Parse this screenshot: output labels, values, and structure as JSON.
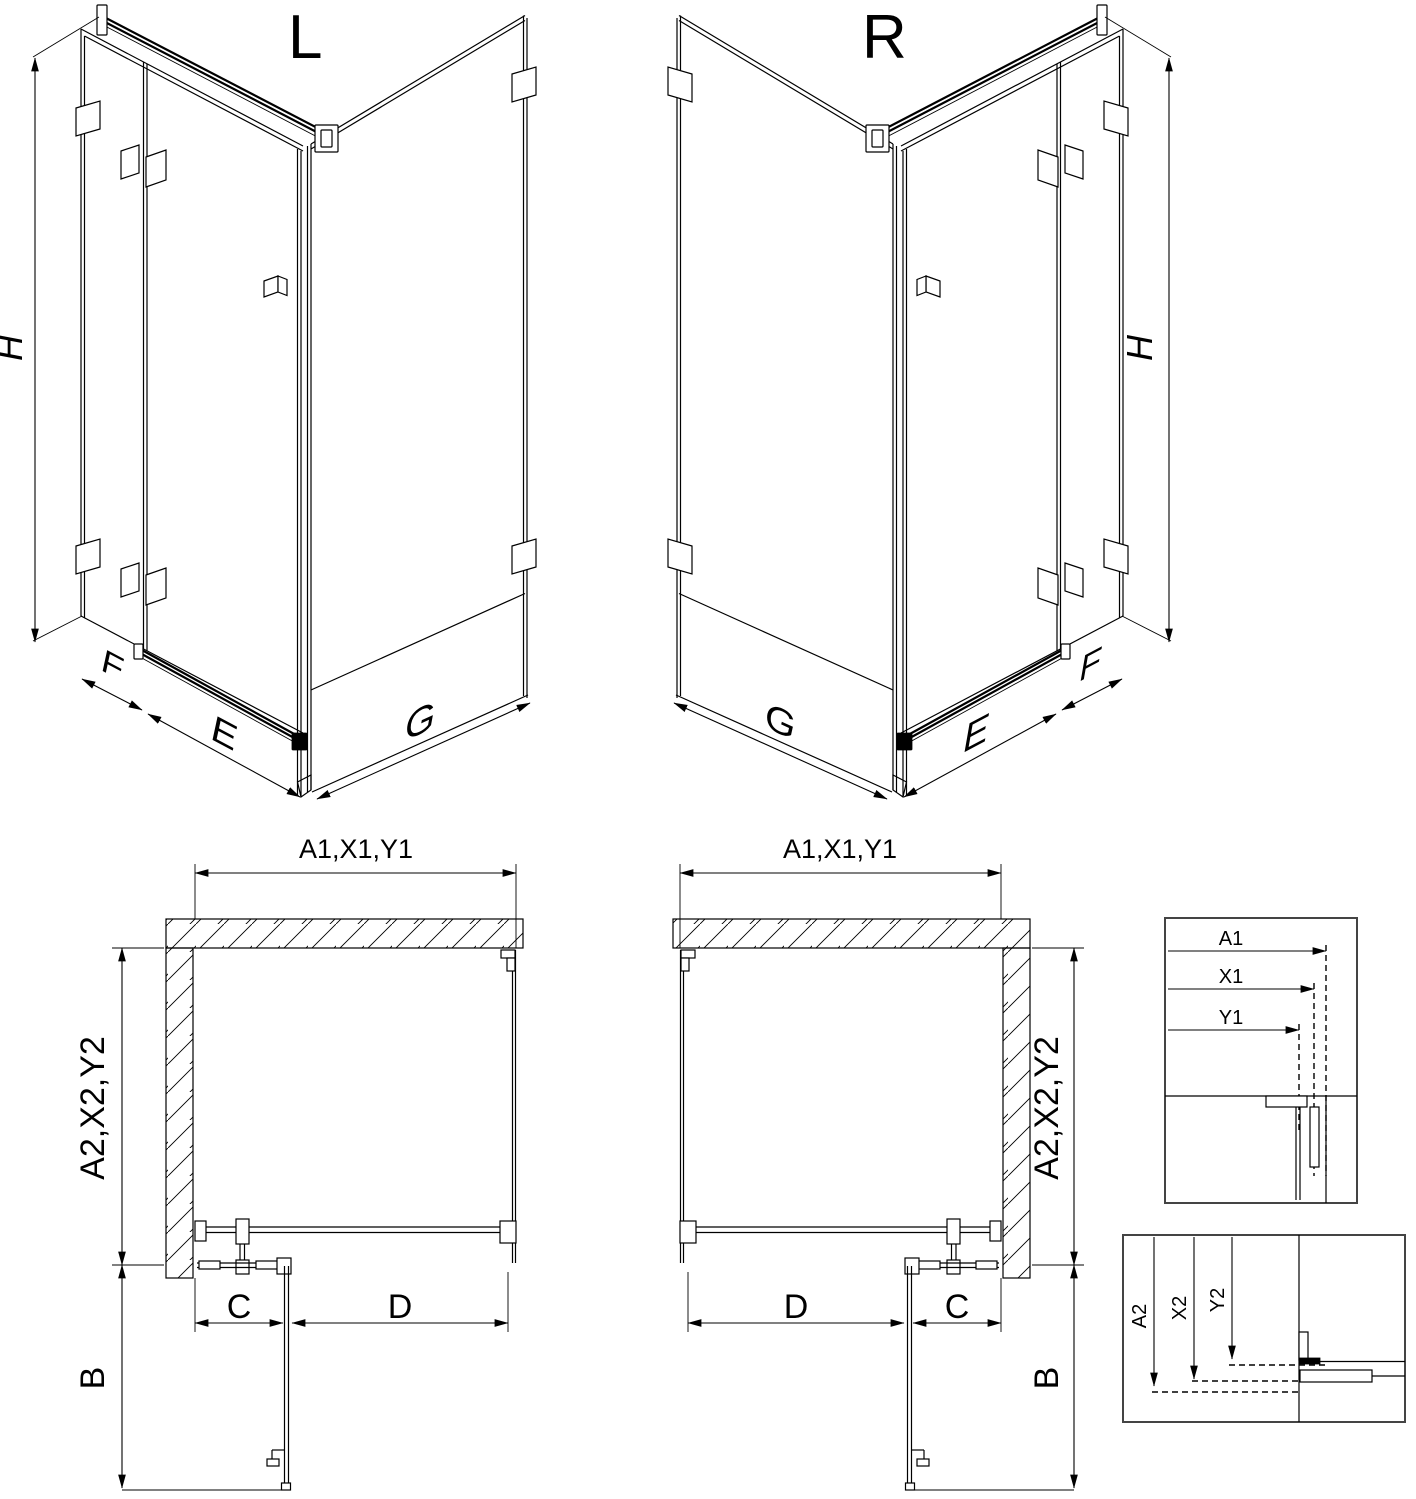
{
  "drawing": {
    "kind": "shower-enclosure-technical-drawing",
    "background": "#ffffff",
    "line_color": "#000000"
  },
  "iso_left": {
    "label": "L",
    "height": "H",
    "fixed_panel": "F",
    "door_panel": "E",
    "side_panel": "G"
  },
  "iso_right": {
    "label": "R",
    "height": "H",
    "fixed_panel": "F",
    "door_panel": "E",
    "side_panel": "G"
  },
  "plan_left": {
    "width": "A1,X1,Y1",
    "depth": "A2,X2,Y2",
    "fixed": "C",
    "door": "D",
    "swing": "B"
  },
  "plan_right": {
    "width": "A1,X1,Y1",
    "depth": "A2,X2,Y2",
    "fixed": "C",
    "door": "D",
    "swing": "B"
  },
  "detail_width": {
    "labels": [
      "A1",
      "X1",
      "Y1"
    ]
  },
  "detail_depth": {
    "labels": [
      "A2",
      "X2",
      "Y2"
    ]
  }
}
